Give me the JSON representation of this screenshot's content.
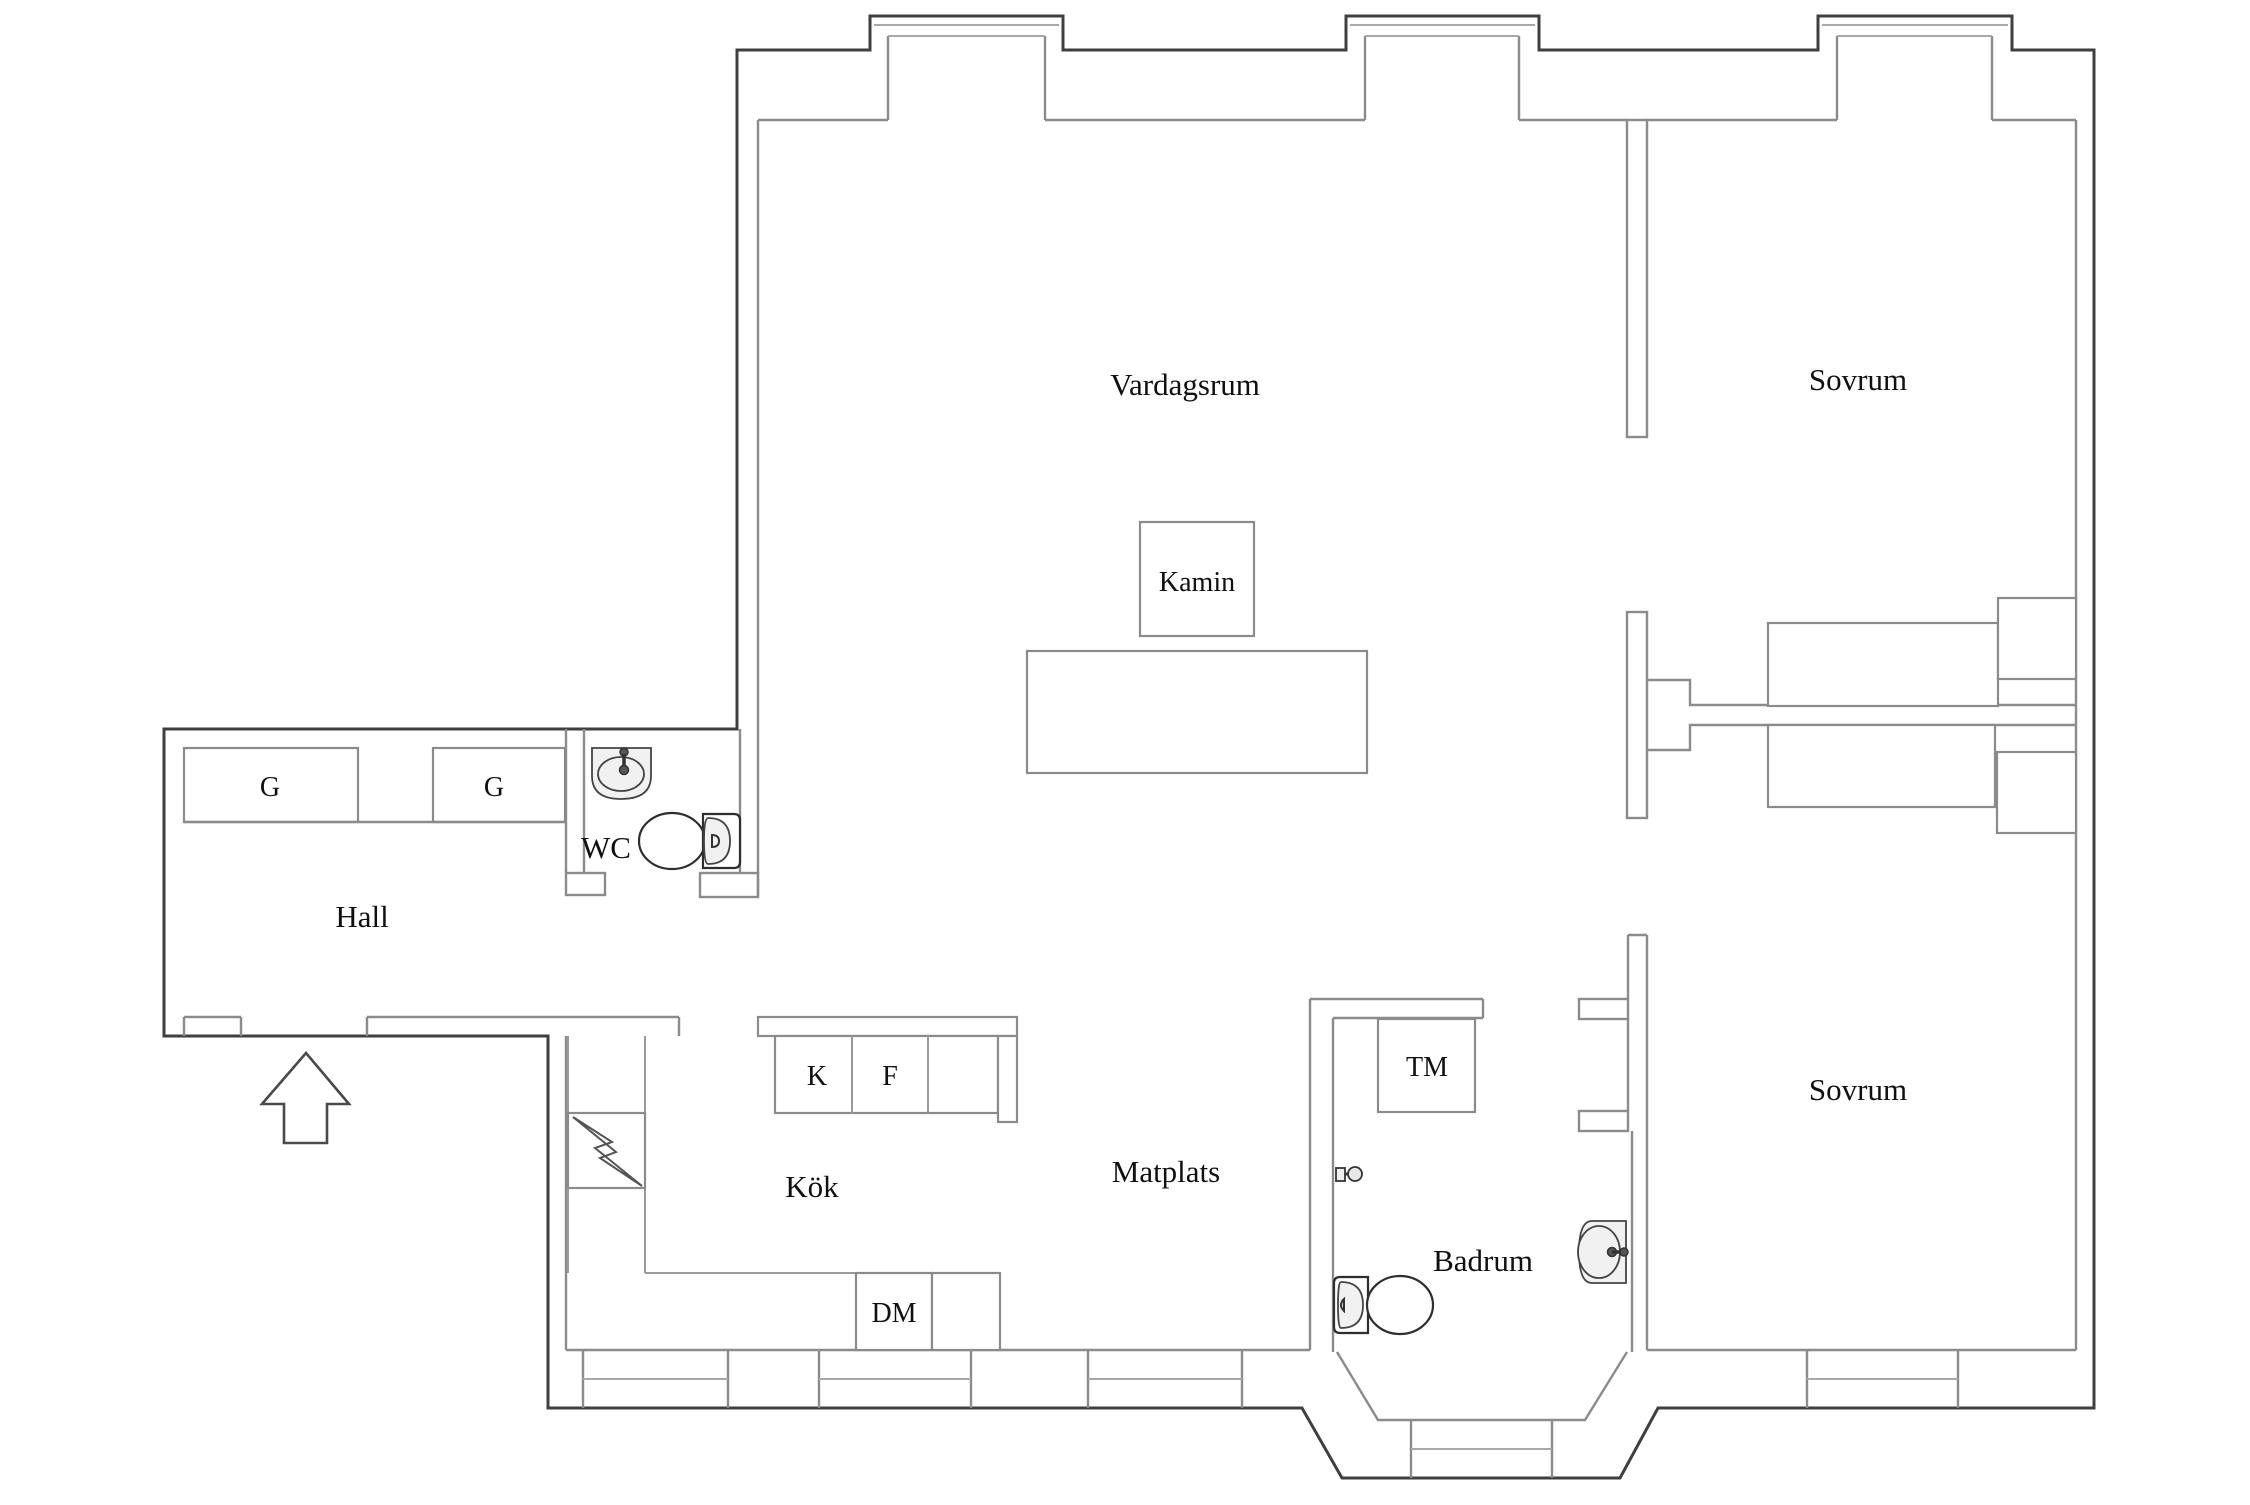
{
  "plan": {
    "type": "apartment-floor-plan",
    "language": "Swedish",
    "background_color": "#ffffff",
    "exterior_wall_color": "#3f3f3f",
    "interior_wall_color": "#8b8b8b",
    "text_color": "#101010"
  },
  "rooms": [
    {
      "id": "vardagsrum",
      "label": "Vardagsrum"
    },
    {
      "id": "sovrum-top",
      "label": "Sovrum"
    },
    {
      "id": "sovrum-bottom",
      "label": "Sovrum"
    },
    {
      "id": "hall",
      "label": "Hall"
    },
    {
      "id": "wc",
      "label": "WC"
    },
    {
      "id": "kok",
      "label": "Kök"
    },
    {
      "id": "matplats",
      "label": "Matplats"
    },
    {
      "id": "badrum",
      "label": "Badrum"
    }
  ],
  "features": [
    {
      "id": "kamin",
      "label": "Kamin",
      "meaning": "fireplace"
    },
    {
      "id": "tvattmaskin",
      "label": "TM",
      "meaning": "washing machine"
    },
    {
      "id": "diskmaskin",
      "label": "DM",
      "meaning": "dishwasher"
    },
    {
      "id": "kyl",
      "label": "K",
      "meaning": "fridge"
    },
    {
      "id": "frys",
      "label": "F",
      "meaning": "freezer"
    },
    {
      "id": "garderob1",
      "label": "G",
      "meaning": "wardrobe"
    },
    {
      "id": "garderob2",
      "label": "G",
      "meaning": "wardrobe"
    }
  ],
  "icons": [
    {
      "name": "entrance-arrow-icon"
    },
    {
      "name": "wc-sink-icon"
    },
    {
      "name": "wc-toilet-icon"
    },
    {
      "name": "badrum-sink-icon"
    },
    {
      "name": "badrum-toilet-icon"
    },
    {
      "name": "shower-mixer-icon"
    },
    {
      "name": "lightning-bolt-icon"
    },
    {
      "name": "bay-window"
    },
    {
      "name": "window"
    }
  ]
}
